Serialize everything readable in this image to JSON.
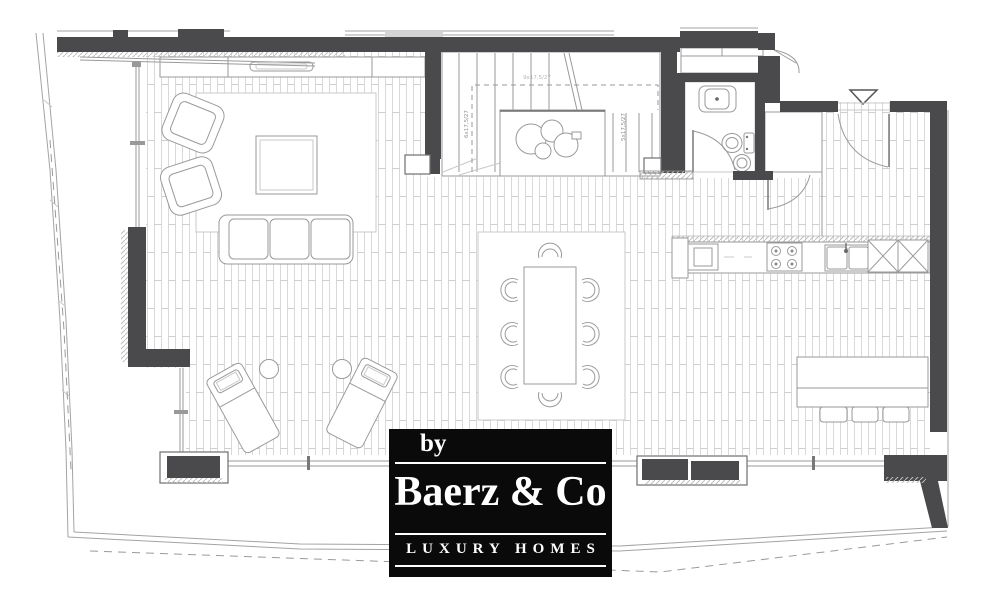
{
  "logo": {
    "by": "by",
    "name": "Baerz & Co",
    "tagline": "LUXURY HOMES"
  },
  "plan": {
    "stair_labels": {
      "left": "6x17,5/27",
      "right": "5x17,5/27",
      "top": "9x17,5/27"
    },
    "colors": {
      "wall": "#4a4a4c",
      "line": "#9a9a9a",
      "line_dark": "#6f6f6f",
      "line_light": "#c9c9c9",
      "floor_line": "#d9d9d9",
      "logo_bg": "#0a0a0a",
      "logo_text": "#ffffff",
      "paper": "#ffffff"
    }
  }
}
